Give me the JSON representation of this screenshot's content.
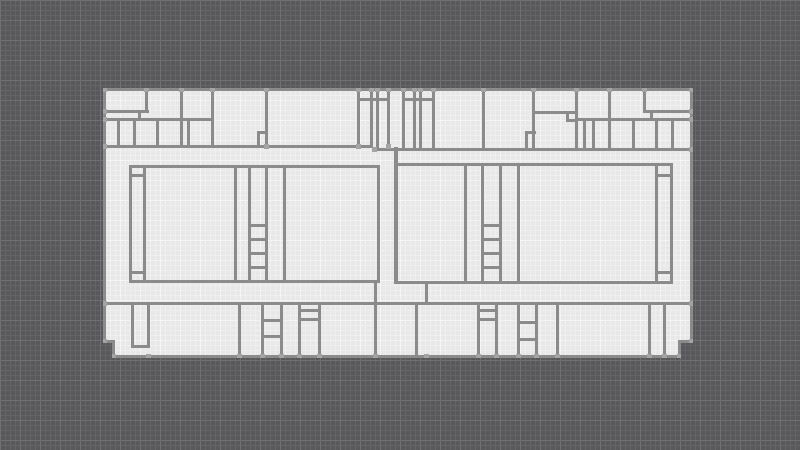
{
  "app": {
    "title": "Floor plan editor canvas",
    "visible_text": ""
  },
  "canvas": {
    "width": 800,
    "height": 450,
    "background_color": "#59595b",
    "grid_minor_color": "#646467",
    "grid_major_color": "#707073",
    "grid_minor_step": 5,
    "grid_major_step": 20
  },
  "plan": {
    "x": 103,
    "y": 88,
    "width": 590,
    "height": 270,
    "floor_color": "#e8e8e8",
    "floor_grid_minor_color": "#efefef",
    "floor_grid_major_color": "#f4f4f4",
    "wall_color": "#8b8b8b",
    "vertex_color": "#a4a4a4",
    "outline": [
      [
        103,
        88
      ],
      [
        693,
        88
      ],
      [
        693,
        343
      ],
      [
        681,
        343
      ],
      [
        681,
        358
      ],
      [
        112,
        358
      ],
      [
        112,
        343
      ],
      [
        103,
        343
      ]
    ],
    "walls": [
      [
        103,
        88,
        590,
        3
      ],
      [
        103,
        88,
        3,
        255
      ],
      [
        690,
        88,
        3,
        255
      ],
      [
        112,
        355,
        569,
        3
      ],
      [
        103,
        340,
        12,
        3
      ],
      [
        112,
        343,
        3,
        12
      ],
      [
        678,
        340,
        15,
        3
      ],
      [
        678,
        343,
        3,
        12
      ],
      [
        145,
        88,
        3,
        25
      ],
      [
        180,
        88,
        3,
        60
      ],
      [
        211,
        88,
        3,
        60
      ],
      [
        265,
        88,
        3,
        60
      ],
      [
        357,
        88,
        3,
        60
      ],
      [
        370,
        88,
        3,
        60
      ],
      [
        376,
        88,
        3,
        60
      ],
      [
        387,
        88,
        3,
        60
      ],
      [
        357,
        98,
        33,
        3
      ],
      [
        103,
        110,
        46,
        3
      ],
      [
        138,
        110,
        3,
        11
      ],
      [
        103,
        118,
        111,
        3
      ],
      [
        117,
        118,
        3,
        30
      ],
      [
        133,
        118,
        3,
        30
      ],
      [
        156,
        118,
        3,
        30
      ],
      [
        187,
        118,
        3,
        30
      ],
      [
        257,
        131,
        11,
        3
      ],
      [
        257,
        131,
        3,
        17
      ],
      [
        402,
        88,
        3,
        63
      ],
      [
        413,
        88,
        3,
        63
      ],
      [
        419,
        88,
        3,
        63
      ],
      [
        432,
        88,
        3,
        63
      ],
      [
        402,
        98,
        33,
        3
      ],
      [
        482,
        88,
        3,
        63
      ],
      [
        532,
        88,
        3,
        63
      ],
      [
        575,
        88,
        3,
        63
      ],
      [
        608,
        88,
        3,
        63
      ],
      [
        643,
        88,
        3,
        25
      ],
      [
        643,
        110,
        47,
        3
      ],
      [
        650,
        110,
        3,
        11
      ],
      [
        532,
        111,
        46,
        3
      ],
      [
        566,
        111,
        3,
        10
      ],
      [
        566,
        119,
        12,
        3
      ],
      [
        577,
        118,
        113,
        3
      ],
      [
        583,
        118,
        3,
        33
      ],
      [
        592,
        118,
        3,
        33
      ],
      [
        632,
        118,
        3,
        33
      ],
      [
        655,
        118,
        3,
        33
      ],
      [
        671,
        118,
        3,
        33
      ],
      [
        525,
        131,
        11,
        3
      ],
      [
        525,
        131,
        3,
        17
      ],
      [
        103,
        145,
        270,
        3
      ],
      [
        373,
        148,
        317,
        3
      ],
      [
        129,
        165,
        251,
        3
      ],
      [
        129,
        280,
        251,
        3
      ],
      [
        129,
        165,
        3,
        118
      ],
      [
        143,
        165,
        3,
        118
      ],
      [
        129,
        174,
        17,
        3
      ],
      [
        129,
        271,
        17,
        3
      ],
      [
        234,
        165,
        3,
        118
      ],
      [
        248,
        165,
        3,
        118
      ],
      [
        265,
        165,
        3,
        118
      ],
      [
        248,
        224,
        20,
        3
      ],
      [
        248,
        238,
        20,
        3
      ],
      [
        248,
        252,
        20,
        3
      ],
      [
        248,
        266,
        20,
        3
      ],
      [
        283,
        165,
        3,
        118
      ],
      [
        377,
        165,
        3,
        118
      ],
      [
        374,
        283,
        3,
        19
      ],
      [
        394,
        147,
        4,
        137
      ],
      [
        394,
        163,
        279,
        3
      ],
      [
        394,
        281,
        279,
        3
      ],
      [
        464,
        163,
        3,
        121
      ],
      [
        481,
        163,
        3,
        121
      ],
      [
        499,
        163,
        3,
        121
      ],
      [
        481,
        224,
        21,
        3
      ],
      [
        481,
        238,
        21,
        3
      ],
      [
        481,
        252,
        21,
        3
      ],
      [
        481,
        266,
        21,
        3
      ],
      [
        517,
        163,
        3,
        121
      ],
      [
        655,
        163,
        3,
        121
      ],
      [
        670,
        163,
        3,
        121
      ],
      [
        655,
        174,
        18,
        3
      ],
      [
        655,
        271,
        18,
        3
      ],
      [
        425,
        284,
        3,
        18
      ],
      [
        103,
        302,
        590,
        3
      ],
      [
        131,
        302,
        3,
        46
      ],
      [
        147,
        302,
        3,
        46
      ],
      [
        131,
        345,
        19,
        3
      ],
      [
        238,
        302,
        3,
        53
      ],
      [
        261,
        302,
        3,
        53
      ],
      [
        280,
        302,
        3,
        53
      ],
      [
        261,
        319,
        22,
        3
      ],
      [
        261,
        335,
        22,
        3
      ],
      [
        298,
        302,
        3,
        53
      ],
      [
        318,
        302,
        3,
        53
      ],
      [
        298,
        309,
        23,
        3
      ],
      [
        298,
        318,
        23,
        3
      ],
      [
        374,
        302,
        3,
        53
      ],
      [
        415,
        302,
        3,
        53
      ],
      [
        477,
        302,
        3,
        53
      ],
      [
        495,
        302,
        3,
        53
      ],
      [
        477,
        309,
        21,
        3
      ],
      [
        477,
        318,
        21,
        3
      ],
      [
        517,
        302,
        3,
        53
      ],
      [
        535,
        302,
        3,
        53
      ],
      [
        517,
        321,
        21,
        3
      ],
      [
        517,
        338,
        21,
        3
      ],
      [
        556,
        302,
        3,
        53
      ],
      [
        648,
        302,
        3,
        53
      ],
      [
        663,
        302,
        3,
        53
      ]
    ],
    "vertices": [
      [
        103,
        88
      ],
      [
        145,
        88
      ],
      [
        180,
        88
      ],
      [
        211,
        88
      ],
      [
        265,
        88
      ],
      [
        357,
        88
      ],
      [
        370,
        88
      ],
      [
        376,
        88
      ],
      [
        387,
        88
      ],
      [
        402,
        88
      ],
      [
        413,
        88
      ],
      [
        419,
        88
      ],
      [
        432,
        88
      ],
      [
        482,
        88
      ],
      [
        532,
        88
      ],
      [
        575,
        88
      ],
      [
        608,
        88
      ],
      [
        643,
        88
      ],
      [
        690,
        88
      ],
      [
        103,
        110
      ],
      [
        103,
        118
      ],
      [
        103,
        145
      ],
      [
        103,
        302
      ],
      [
        103,
        340
      ],
      [
        690,
        110
      ],
      [
        690,
        118
      ],
      [
        690,
        148
      ],
      [
        690,
        302
      ],
      [
        690,
        340
      ],
      [
        112,
        355
      ],
      [
        147,
        355
      ],
      [
        238,
        355
      ],
      [
        261,
        355
      ],
      [
        280,
        355
      ],
      [
        298,
        355
      ],
      [
        318,
        355
      ],
      [
        374,
        355
      ],
      [
        425,
        355
      ],
      [
        477,
        355
      ],
      [
        495,
        355
      ],
      [
        517,
        355
      ],
      [
        535,
        355
      ],
      [
        556,
        355
      ],
      [
        648,
        355
      ],
      [
        663,
        355
      ],
      [
        678,
        355
      ],
      [
        265,
        145
      ],
      [
        357,
        145
      ],
      [
        387,
        145
      ],
      [
        373,
        148
      ]
    ]
  }
}
